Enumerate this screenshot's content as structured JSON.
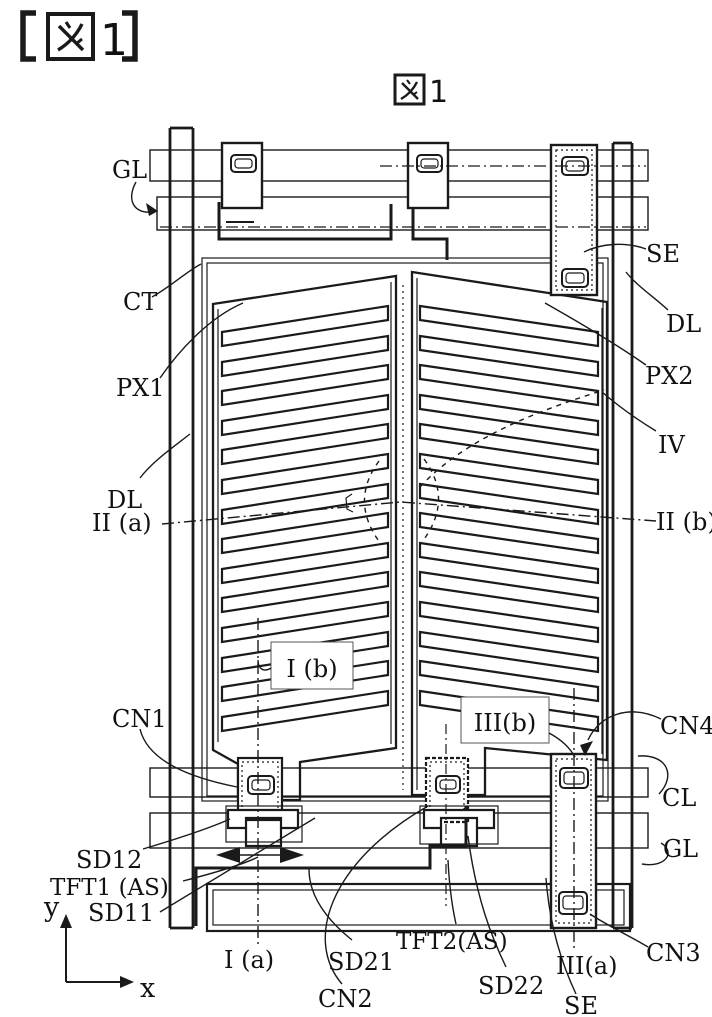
{
  "header": {
    "title": "【図 1】",
    "figure_char": "図",
    "number": "1"
  },
  "figure": {
    "caption": "図1",
    "caption_number": "1",
    "ink_color": "#1a1a1a",
    "background_color": "#ffffff",
    "labels": {
      "gl_top": "GL",
      "se_top": "SE",
      "ct": "CT",
      "dl_right": "DL",
      "px1": "PX1",
      "px2": "PX2",
      "iv": "IV",
      "dl_left": "DL",
      "ii_a": "II (a)",
      "ii_b": "II (b)",
      "cn1": "CN1",
      "i_b": "I (b)",
      "iii_b": "III(b)",
      "cn4": "CN4",
      "cl": "CL",
      "gl_bottom": "GL",
      "sd12": "SD12",
      "tft1": "TFT1 (AS)",
      "sd11": "SD11",
      "i_a": "I (a)",
      "sd21": "SD21",
      "tft2": "TFT2(AS)",
      "sd22": "SD22",
      "iii_a": "III(a)",
      "cn2": "CN2",
      "se_bottom": "SE",
      "cn3": "CN3"
    },
    "axes": {
      "x_label": "x",
      "y_label": "y"
    }
  }
}
